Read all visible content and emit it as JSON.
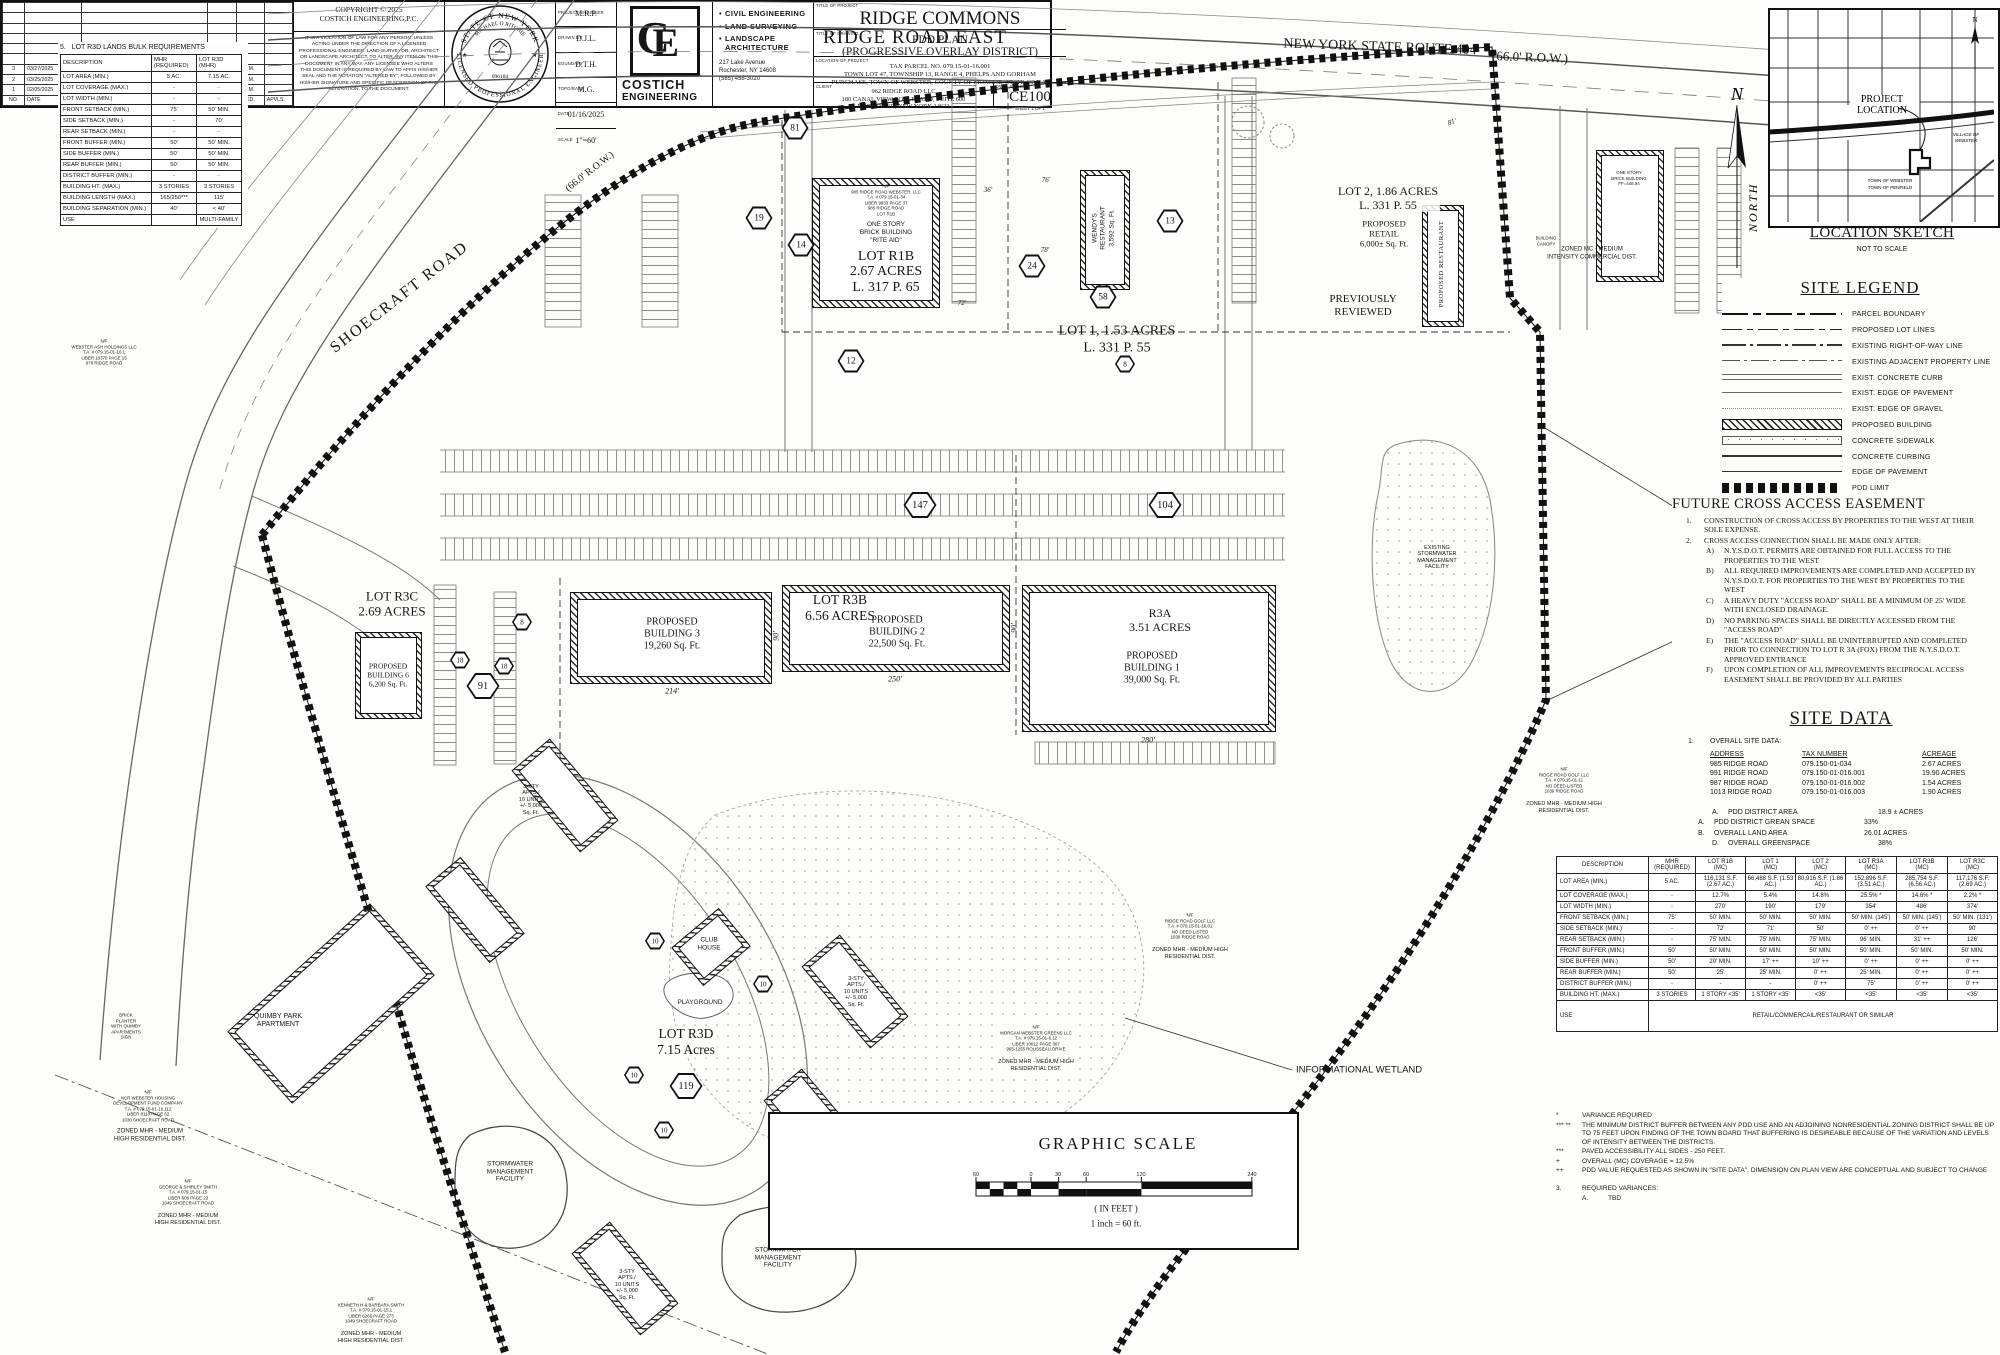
{
  "colors": {
    "ink": "#161616",
    "paper": "#fdfdfb",
    "gray_line": "#777777"
  },
  "r3d_table": {
    "number": "5.",
    "title": "LOT R3D LANDS BULK REQUIREMENTS",
    "h": {
      "desc": "DESCRIPTION",
      "mhr1": "MHR",
      "mhr2": "(REQUIRED)",
      "lot1": "LOT R3D",
      "lot2": "(MHR)"
    },
    "rows": [
      {
        "d": "LOT AREA (MIN.)",
        "a": "5 AC.",
        "b": "7.15 AC."
      },
      {
        "d": "LOT COVERAGE (MAX.)",
        "a": "-",
        "b": "-"
      },
      {
        "d": "LOT WIDTH (MIN.)",
        "a": "-",
        "b": "-"
      },
      {
        "d": "FRONT SETBACK (MIN.)",
        "a": "75'",
        "b": "50' MIN."
      },
      {
        "d": "SIDE SETBACK (MIN.)",
        "a": "-",
        "b": "70'"
      },
      {
        "d": "REAR SETBACK (MIN.)",
        "a": "-",
        "b": "-"
      },
      {
        "d": "FRONT BUFFER (MIN.)",
        "a": "50'",
        "b": "50' MIN."
      },
      {
        "d": "SIDE BUFFER (MIN.)",
        "a": "50'",
        "b": "50' MIN."
      },
      {
        "d": "REAR BUFFER (MIN.)",
        "a": "50'",
        "b": "50' MIN."
      },
      {
        "d": "DISTRICT BUFFER (MIN.)",
        "a": "-",
        "b": "-"
      },
      {
        "d": "BUILDING HT. (MAX.)",
        "a": "3 STORIES",
        "b": "3 STORIES"
      },
      {
        "d": "BUILDING LENGTH (MAX.)",
        "a": "165/250***",
        "b": "115'"
      },
      {
        "d": "BUILDING SEPARATION (MIN.)",
        "a": "40'",
        "b": "< 40'"
      },
      {
        "d": "USE",
        "a": "",
        "b": "MULTI-FAMILY"
      }
    ]
  },
  "roads": {
    "ridge_road_east": "RIDGE ROAD EAST",
    "route_404": "NEW YORK STATE ROUTE 404",
    "row_404": "(66.0' R.O.W.)",
    "shoecraft": "SHOECRAFT ROAD",
    "shoecraft_row": "(66.0' R.O.W.)"
  },
  "location_sketch": {
    "title": "LOCATION SKETCH",
    "subtitle": "NOT TO SCALE",
    "project_location_1": "PROJECT",
    "project_location_2": "LOCATION",
    "north": "N",
    "village_1": "VILLAGE OF",
    "village_2": "WEBSTER",
    "town_1": "TOWN  OF  WEBSTER",
    "town_2": "TOWN  OF  PENFIELD"
  },
  "legend": {
    "title": "SITE LEGEND",
    "items": [
      {
        "label": "PARCEL BOUNDARY",
        "sym": "sym-parcel"
      },
      {
        "label": "PROPOSED LOT LINES",
        "sym": "sym-lotline"
      },
      {
        "label": "EXISTING RIGHT-OF-WAY LINE",
        "sym": "sym-row"
      },
      {
        "label": "EXISTING ADJACENT PROPERTY LINE",
        "sym": "sym-adj"
      },
      {
        "label": "EXIST. CONCRETE CURB",
        "sym": "sym-curb"
      },
      {
        "label": "EXIST. EDGE OF PAVEMENT",
        "sym": "sym-eop"
      },
      {
        "label": "EXIST. EDGE OF GRAVEL",
        "sym": "sym-gravel"
      },
      {
        "label": "PROPOSED BUILDING",
        "sym": "sym-bldg"
      },
      {
        "label": "CONCRETE SIDEWALK",
        "sym": "sym-walk"
      },
      {
        "label": "CONCRETE CURBING",
        "sym": "sym-curbing"
      },
      {
        "label": "EDGE OF PAVEMENT",
        "sym": "sym-pave"
      },
      {
        "label": "PDD LIMIT",
        "sym": "sym-pdd"
      }
    ]
  },
  "cross_access": {
    "title": "FUTURE CROSS ACCESS EASEMENT",
    "items": [
      {
        "n": "1.",
        "t": "CONSTRUCTION OF CROSS ACCESS BY PROPERTIES TO THE WEST AT THEIR SOLE EXPENSE.",
        "cls": "lvl1"
      },
      {
        "n": "2.",
        "t": "CROSS ACCESS CONNECTION SHALL BE MADE ONLY AFTER:",
        "cls": "lvl1"
      },
      {
        "n": "A)",
        "t": "N.Y.S.D.O.T. PERMITS ARE OBTAINED FOR FULL ACCESS TO THE  PROPERTIES TO THE WEST",
        "cls": "lvl2"
      },
      {
        "n": "B)",
        "t": "ALL REQUIRED IMPROVEMENTS ARE COMPLETED AND ACCEPTED BY N.Y.S.D.O.T. FOR PROPERTIES TO THE WEST BY PROPERTIES TO THE WEST",
        "cls": "lvl2"
      },
      {
        "n": "C)",
        "t": "A HEAVY DUTY \"ACCESS ROAD\" SHALL BE A MINIMUM OF 25' WIDE WITH ENCLOSED DRAINAGE.",
        "cls": "lvl2"
      },
      {
        "n": "D)",
        "t": "NO PARKING SPACES SHALL BE DIRECTLY ACCESSED FROM THE \"ACCESS ROAD\"",
        "cls": "lvl2"
      },
      {
        "n": "E)",
        "t": "THE \"ACCESS ROAD\" SHALL BE UNINTERRUPTED AND COMPLETED PRIOR TO CONNECTION TO LOT R 3A (FOX) FROM THE N.Y.S.D.O.T. APPROVED ENTRANCE",
        "cls": "lvl2"
      },
      {
        "n": "F)",
        "t": "UPON COMPLETION OF ALL IMPROVEMENTS RECIPROCAL ACCESS EASEMENT SHALL BE PROVIDED BY ALL PARTIES",
        "cls": "lvl2"
      }
    ]
  },
  "site_data": {
    "title": "SITE DATA",
    "s1n": "1.",
    "s1t": "OVERALL SITE DATA:",
    "col_address": "ADDRESS",
    "col_tax": "TAX NUMBER",
    "col_acreage": "ACREAGE",
    "parcels": [
      {
        "a": "985 RIDGE ROAD",
        "t": "079.150-01-034",
        "c": "2.67 ACRES"
      },
      {
        "a": "991 RIDGE ROAD",
        "t": "079.150-01-016.001",
        "c": "19.90 ACRES"
      },
      {
        "a": "987 RIDGE ROAD",
        "t": "079.150-01-016.002",
        "c": "1.54 ACRES"
      },
      {
        "a": "1013 RIDGE ROAD",
        "t": "079.150-01-016.003",
        "c": "1.90 ACRES"
      }
    ],
    "metrics": [
      {
        "n": "A.",
        "t": "PDD DISTRICT AREA",
        "v": "18.9 ± ACRES",
        "cls": "lvl2"
      },
      {
        "n": "A.",
        "t": "PDD DISTRICT GREAN SPACE",
        "v": "33%",
        "cls": "lvl1"
      },
      {
        "n": "B.",
        "t": "OVERALL LAND AREA",
        "v": "26.01 ACRES",
        "cls": "lvl1"
      },
      {
        "n": "D.",
        "t": "OVERALL GREENSPACE",
        "v": "38%",
        "cls": "lvl2"
      }
    ],
    "s2n": "2.",
    "s2t": "PDD LANDS BULK REQUIREMENTS"
  },
  "pdd_table": {
    "headers": [
      {
        "l1": "DESCRIPTION",
        "l2": ""
      },
      {
        "l1": "MHR",
        "l2": "(REQUIRED)"
      },
      {
        "l1": "LOT R1B",
        "l2": "(MC)"
      },
      {
        "l1": "LOT 1",
        "l2": "(MC)"
      },
      {
        "l1": "LOT 2",
        "l2": "(MC)"
      },
      {
        "l1": "LOT R3A",
        "l2": "(MC)"
      },
      {
        "l1": "LOT R3B",
        "l2": "(MC)"
      },
      {
        "l1": "LOT R3C",
        "l2": "(MC)"
      }
    ],
    "rows": [
      {
        "d": "LOT AREA (MIN.)",
        "c1": "5 AC.",
        "c2": "116,131 S.F. (2.67 AC.)",
        "c3": "66,488 S.F. (1.53 AC.)",
        "c4": "80,916 S.F. (1.86 AC.)",
        "c5": "152,896 S.F. (3.51 AC.)",
        "c6": "285,754 S.F. (6.56 AC.)",
        "c7": "117,176 S.F. (2.69 AC.)"
      },
      {
        "d": "LOT COVERAGE (MAX.)",
        "c1": "-",
        "c2": "12.7%",
        "c3": "5.4%",
        "c4": "14.8%",
        "c5": "25.5% *",
        "c6": "14.6% *",
        "c7": "2.2% *"
      },
      {
        "d": "LOT WIDTH (MIN.)",
        "c1": "-",
        "c2": "270'",
        "c3": "190'",
        "c4": "179'",
        "c5": "354'",
        "c6": "486'",
        "c7": "374'"
      },
      {
        "d": "FRONT SETBACK (MIN.)",
        "c1": "75'",
        "c2": "50' MIN.",
        "c3": "50' MIN.",
        "c4": "50' MIN.",
        "c5": "50' MIN. (145')",
        "c6": "50' MIN. (145')",
        "c7": "50' MIN. (131')"
      },
      {
        "d": "SIDE SETBACK (MIN.)",
        "c1": "-",
        "c2": "72'",
        "c3": "71'",
        "c4": "50'",
        "c5": "0' ++",
        "c6": "0' ++",
        "c7": "90'"
      },
      {
        "d": "REAR SETBACK (MIN.)",
        "c1": "-",
        "c2": "75' MIN.",
        "c3": "75' MIN.",
        "c4": "75' MIN.",
        "c5": "96' MIN.",
        "c6": "31' ++",
        "c7": "126'"
      },
      {
        "d": "FRONT BUFFER (MIN.)",
        "c1": "50'",
        "c2": "50' MIN.",
        "c3": "50' MIN.",
        "c4": "50' MIN.",
        "c5": "50' MIN.",
        "c6": "50' MIN.",
        "c7": "50' MIN."
      },
      {
        "d": "SIDE BUFFER (MIN.)",
        "c1": "50'",
        "c2": "20' MIN.",
        "c3": "17' ++",
        "c4": "10' ++",
        "c5": "0' ++",
        "c6": "0' ++",
        "c7": "0' ++"
      },
      {
        "d": "REAR BUFFER (MIN.)",
        "c1": "50'",
        "c2": "25'",
        "c3": "25' MIN.",
        "c4": "0' ++",
        "c5": "25' MIN.",
        "c6": "0' ++",
        "c7": "0' ++"
      },
      {
        "d": "DISTRICT BUFFER (MIN.)",
        "c1": "-",
        "c2": "-",
        "c3": "-",
        "c4": "0' ++",
        "c5": "75'",
        "c6": "0' ++",
        "c7": "0' ++"
      },
      {
        "d": "BUILDING HT. (MAX.)",
        "c1": "3 STORIES",
        "c2": "1 STORY <35'",
        "c3": "1 STORY <35'",
        "c4": "<35'",
        "c5": "<35'",
        "c6": "<35'",
        "c7": "<35'"
      }
    ],
    "use_label": "USE",
    "use_value": "RETAIL/COMMERCAIL/RESTAURANT OR SIMILAR"
  },
  "pdd_notes": {
    "items": [
      {
        "n": "*",
        "t": "VARIANCE REQUIRED"
      },
      {
        "n": "*** **",
        "t": "THE MINIMUM DISTRICT BUFFER BETWEEN ANY PDD USE AND AN ADJOINING NONRESIDENTIAL ZONING DISTRICT SHALL BE UP TO 75 FEET UPON FINDING OF THE TOWN BOARD THAT BUFFERING IS DESIREABLE BECAUSE OF THE VARIATION AND LEVELS OF INTENSITY BETWEEN THE DISTRICTS."
      },
      {
        "n": "***",
        "t": "PAVED ACCESSIBILITY ALL SIDES - 250 FEET."
      },
      {
        "n": "+",
        "t": "OVERALL (MC) COVERAGE  = 12.5%"
      },
      {
        "n": "++",
        "t": "PDD VALUE REQUESTED AS SHOWN IN \"SITE DATA\", DIMENSION ON PLAN VIEW ARE CONCEPTUAL AND SUBJECT TO CHANGE"
      }
    ],
    "var_n": "3.",
    "var_t": "REQUIRED VARIANCES:",
    "var_a": "A.",
    "var_v": "TBD"
  },
  "graphic_scale": {
    "title": "GRAPHIC SCALE",
    "ticks": [
      "60",
      "0",
      "30",
      "60",
      "120",
      "240"
    ],
    "units": "( IN FEET )",
    "ratio": "1 inch = 60 ft."
  },
  "revisions": {
    "headers": {
      "no": "NO.",
      "date": "DATE",
      "rev": "REVISION",
      "by": "BY",
      "chkd": "CHKD.",
      "apvls": "APVLS."
    },
    "rows": [
      {
        "no": "3",
        "date": "03/27/2025",
        "rev": "REVISED FOR TOWN TOWN MEETING",
        "by": "M.P.M.",
        "chkd": "M.P.M.",
        "apvls": ""
      },
      {
        "no": "2",
        "date": "03/25/2025",
        "rev": "REVISED PER CODE UPDATES/TOWN COMMENTS",
        "by": "M.P.M.",
        "chkd": "M.P.M.",
        "apvls": ""
      },
      {
        "no": "1",
        "date": "02/05/2025",
        "rev": "REVISED PER CLIENTS COMMENTS",
        "by": "D.J.L.",
        "chkd": "M.P.M.",
        "apvls": ""
      }
    ]
  },
  "title_block": {
    "copyright_1": "COPYRIGHT © 2025",
    "copyright_2": "COSTICH ENGINEERING,P.C.",
    "disclaimer": "IT IS A VIOLATION OF LAW FOR ANY PERSON, UNLESS ACTING UNDER THE DIRECTION OF A LICENSED PROFESSIONAL ENGINEER, LAND SURVEYOR, ARCHITECT OR LANDSCAPE ARCHITECT, TO ALTER ANY ITEM ON THIS DOCUMENT IN ANY WAY. ANY LICENS­EE WHO ALTERS THIS DOCUMENT IS REQUIRED BY LAW TO AFFIX HIS/HER SEAL AND THE NOTATION \"ALTERED BY\", FOLLOWED BY HIS/HER SIGNATURE AND SPECIFIC DESCRIPTION OF THE ALTERATION, TO THE DOCUMENT.",
    "seal_top": "STATE OF NEW YORK",
    "seal_name": "MICHAEL O RITCHIE",
    "seal_no": "096184",
    "seal_ring": "LICENSED PROFESSIONAL ENGINEER",
    "credits": [
      {
        "label": "PROJECT ENGINEER",
        "value": "M.R.P."
      },
      {
        "label": "DRAWN BY",
        "value": "D.J.L."
      },
      {
        "label": "BOUNDARY",
        "value": "D.T.H."
      },
      {
        "label": "TOPO/BASE",
        "value": "M.G."
      },
      {
        "label": "DATE",
        "value": "01/16/2025"
      },
      {
        "label": "SCALE",
        "value": "1\"=60'"
      }
    ],
    "logo_c": "C",
    "logo_e": "E",
    "company_1": "COSTICH",
    "company_2": "ENGINEERING",
    "services": [
      "CIVIL ENGINEERING",
      "LAND SURVEYING",
      "LANDSCAPE ARCHITECTURE"
    ],
    "address": [
      "217 Lake Avenue",
      "Rochester, NY 14608",
      "(585) 458-3020"
    ],
    "label_project": "TITLE OF PROJECT",
    "project": "RIDGE COMMONS",
    "label_drawing": "TITLE OF DRAWING",
    "drawing_1": "PDD PLAN",
    "drawing_2": "(PROGRESSIVE OVERLAY DISTRICT)",
    "label_location": "LOCATION OF PROJECT",
    "location": [
      "TAX PARCEL NO. 079.15-01-16.001",
      "TOWN LOT 47, TOWNSHIP 13, RANGE 4, PHELPS AND GORHAM",
      "PURCHASE, TOWN OF WEBSTER, COUNTY OF MONROE, STATE OF N.Y."
    ],
    "label_client": "CLIENT",
    "client": [
      "962 RIDGE ROAD LLC",
      "180 CANAL VIEW BOULEVARD, SUITE 600",
      "ROCHESTER, NEW YORK 14623"
    ],
    "label_dwg": "DWG. #",
    "dwg_no": "4523",
    "sheet_code": "CE100",
    "sheet_note": "SHEET 1 OF 1"
  },
  "plan": {
    "north_n": "N",
    "north_word": "NORTH",
    "nf_r1b": [
      "N/F",
      "985 RIDGE ROAD WEBSTER, LLC",
      "T.A. # 079.15-01-34",
      "LIBER 9933 PAGE 37",
      "985 RIDGE ROAD",
      "LOT R1B"
    ],
    "rite_aid": [
      "ONE STORY",
      "BRICK BUILDING",
      "\"RITE AID\""
    ],
    "lot_r1b": [
      "LOT  R1B",
      "2.67 ACRES",
      "L. 317 P. 65"
    ],
    "wendys": [
      "WENDY'S",
      "RESTAURANT",
      "3,592 Sq. Ft."
    ],
    "lot_1": [
      "LOT  1, 1.53 ACRES",
      "L. 331 P. 55"
    ],
    "lot_2": [
      "LOT  2, 1.86 ACRES",
      "L. 331 P. 55"
    ],
    "lot_2_retail": [
      "PROPOSED",
      "RETAIL",
      "6,000± Sq. Ft."
    ],
    "proposed_restaurant": "PROPOSED RESTAURANT",
    "previously_reviewed": [
      "PREVIOUSLY",
      "REVIEWED"
    ],
    "one_story_brick": [
      "ONE STORY",
      "BRICK BUILDING",
      "FF=448.94"
    ],
    "building_canopy": [
      "BUILDING",
      "CANOPY"
    ],
    "zoned_mc": [
      "ZONED MC - MEDIUM",
      "INTENSITY COMMERCIAL DIST."
    ],
    "lot_r3b": [
      "LOT  R3B",
      "6.56 ACRES"
    ],
    "bldg3": [
      "PROPOSED",
      "BUILDING  3",
      "19,260 Sq. Ft."
    ],
    "bldg2": [
      "PROPOSED",
      "BUILDING  2",
      "22,500 Sq. Ft."
    ],
    "r3a": [
      "R3A",
      "3.51 ACRES"
    ],
    "bldg1": [
      "PROPOSED",
      "BUILDING  1",
      "39,000 Sq. Ft."
    ],
    "lot_r3c": [
      "LOT  R3C",
      "2.69 ACRES"
    ],
    "bldg6": [
      "PROPOSED",
      "BUILDING 6",
      "6,200 Sq. Ft."
    ],
    "lot_r3d": [
      "LOT  R3D",
      "7.15 Acres"
    ],
    "club_house": [
      "CLUB",
      "HOUSE"
    ],
    "playground": "PLAYGROUND",
    "quimby": [
      "QUIMBY PARK",
      "APARTMENT"
    ],
    "apts": [
      "3-STY",
      "APTS./",
      "10 UNITS",
      "+/- 5,000",
      "Sq. Ft."
    ],
    "stormwater": [
      "STORMWATER",
      "MANAGEMENT",
      "FACILITY"
    ],
    "existing_stormwater": [
      "EXISTING",
      "STORMWATER",
      "MANAGEMENT",
      "FACILITY"
    ],
    "wetland": "INFORMATIONAL WETLAND",
    "brick_planter": [
      "BRICK",
      "PLANTER",
      "WITH QUIMBY",
      "APARTMENTS",
      "SIGN"
    ],
    "nf_webster_ash": [
      "N/F",
      "WEBSTER ASH HOLDINGS LLC",
      "T.A. # 079.15-01-16.1",
      "LIBER 10370 PAGE 15",
      "970 RIDGE ROAD"
    ],
    "nf_ncr": [
      "N/F",
      "NCR WEBSTER HOUSING",
      "DEVELOPMENT FUND COMPANY",
      "T.A. # 079.15-01-16.112",
      "LIBER 8110 PAGE 62",
      "1030 SHOECRAFT ROAD"
    ],
    "nf_smith_g": [
      "N/F",
      "GEORGE & SHIRLEY SMITH",
      "T.A. # 079.15-01-15",
      "LIBER 609 PAGE 23",
      "1049 SHOECRAFT ROAD"
    ],
    "nf_smith_k": [
      "N/F",
      "KENNETH H & BARBARA SMITH",
      "T.A. # 079.15-01-15.1",
      "LIBER 6266 PAGE 273",
      "1049 SHOECRAFT ROAD"
    ],
    "nf_golf_1": [
      "N/F",
      "RIDGE ROAD GOLF LLC",
      "T.A. # 079.15-01-16.01",
      "NO DEED LISTED",
      "1039 RIDGE ROAD"
    ],
    "nf_golf_2": [
      "N/F",
      "RIDGE ROAD GOLF LLC",
      "T.A. # 079.15-01-11",
      "NO DEED LISTED",
      "1039 RIDGE ROAD"
    ],
    "nf_morgan": [
      "N/F",
      "MORGAN WEBSTER GREENS LLC",
      "T.A. # 079.15-01-6.12",
      "LIBER 10612 PAGE 367",
      "965-1255 ROUSSEAU DRIVE"
    ],
    "zoned_mhr": [
      "ZONED MHR - MEDIUM",
      "HIGH RESIDENTIAL DIST."
    ],
    "zoned_mhr_full": [
      "ZONED MHR - MEDIUM HIGH",
      "RESIDENTIAL DIST."
    ],
    "dims": {
      "d214": "214'",
      "d250": "250'",
      "d280": "280'",
      "d90a": "90'",
      "d90b": "90'",
      "d76": "76'",
      "d78": "78'",
      "d72": "72'",
      "d36": "36'",
      "d81": "81'"
    },
    "badges": {
      "b81": "81",
      "b19": "19",
      "b14": "14",
      "b12": "12",
      "b24": "24",
      "b58": "58",
      "b13": "13",
      "b8a": "8",
      "b147": "147",
      "b104": "104",
      "b91": "91",
      "b18a": "18",
      "b18b": "18",
      "b8b": "8",
      "b119": "119",
      "b10a": "10",
      "b10b": "10",
      "b10c": "10",
      "b10d": "10"
    }
  }
}
